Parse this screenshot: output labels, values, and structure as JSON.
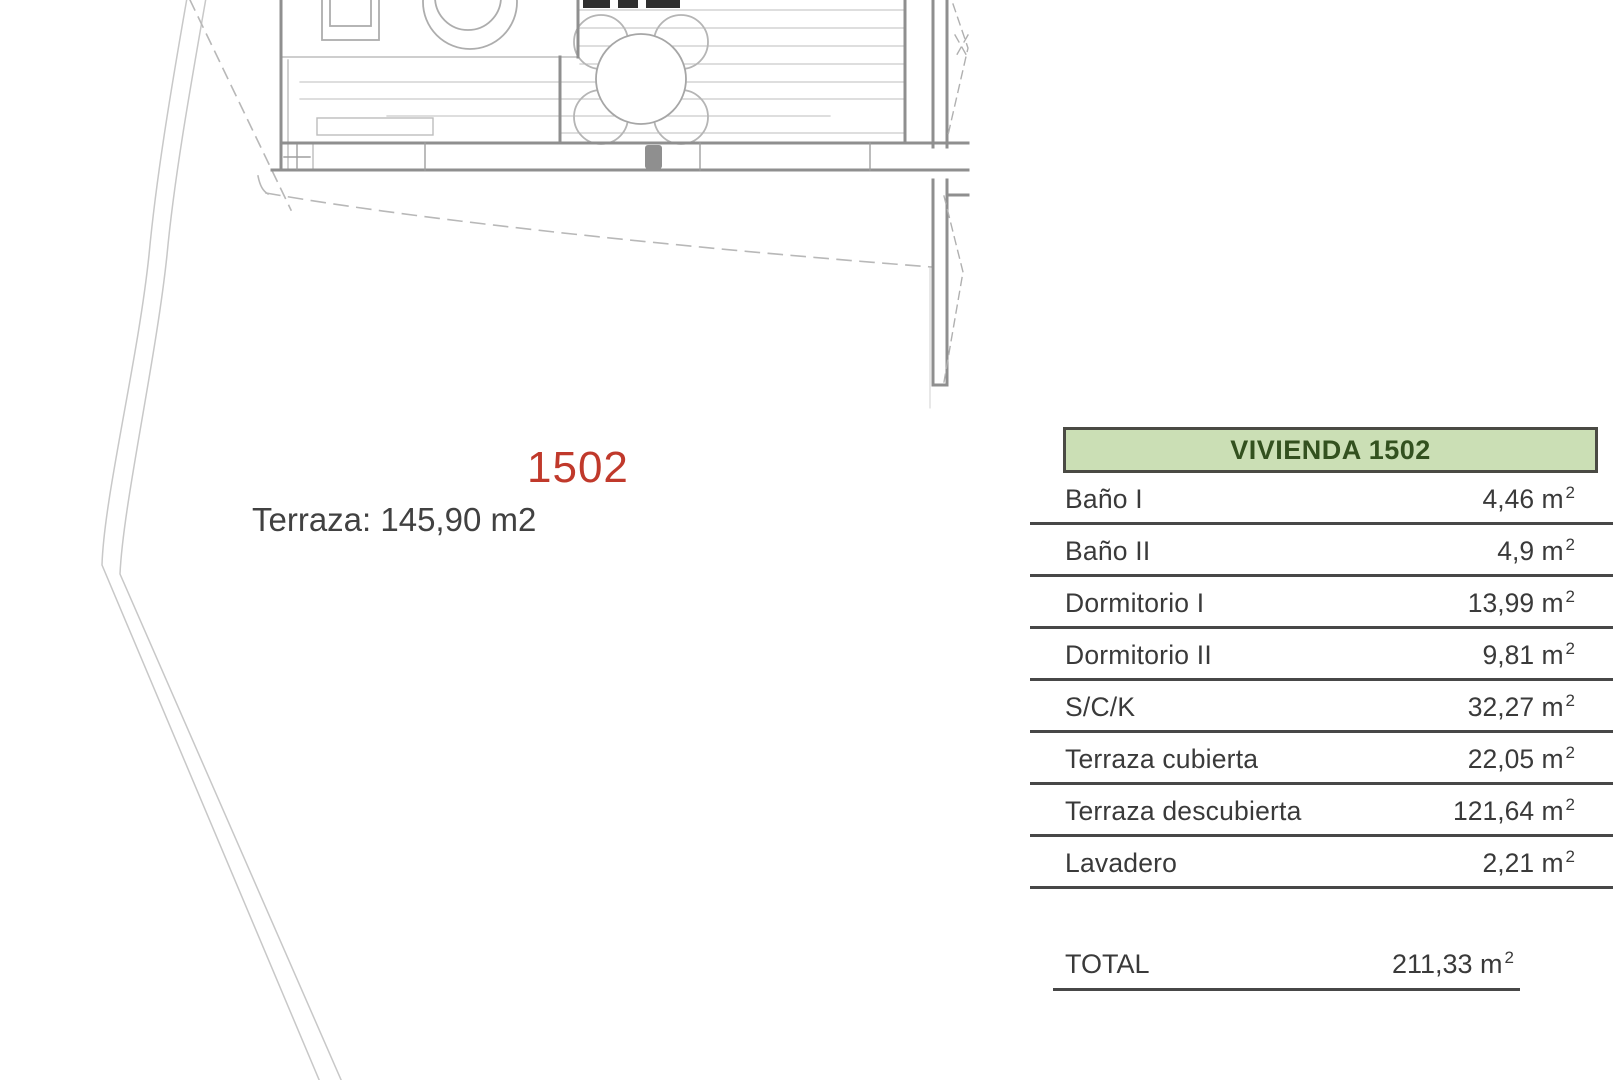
{
  "plan": {
    "unit_number": "1502",
    "unit_number_color": "#c0392b",
    "terrace_label": "Terraza: 145,90 m2",
    "line_color": "#9a9a9a"
  },
  "area_table": {
    "header": "VIVIENDA 1502",
    "header_bg": "#cbdfb5",
    "header_text_color": "#33511f",
    "unit": "m",
    "unit_exponent": "2",
    "rows": [
      {
        "label": "Baño I",
        "area": "4,46"
      },
      {
        "label": "Baño II",
        "area": "4,9"
      },
      {
        "label": "Dormitorio I",
        "area": "13,99"
      },
      {
        "label": "Dormitorio II",
        "area": "9,81"
      },
      {
        "label": "S/C/K",
        "area": "32,27"
      },
      {
        "label": "Terraza cubierta",
        "area": "22,05"
      },
      {
        "label": "Terraza descubierta",
        "area": "121,64"
      },
      {
        "label": "Lavadero",
        "area": "2,21"
      }
    ],
    "total": {
      "label": "TOTAL",
      "area": "211,33"
    }
  }
}
